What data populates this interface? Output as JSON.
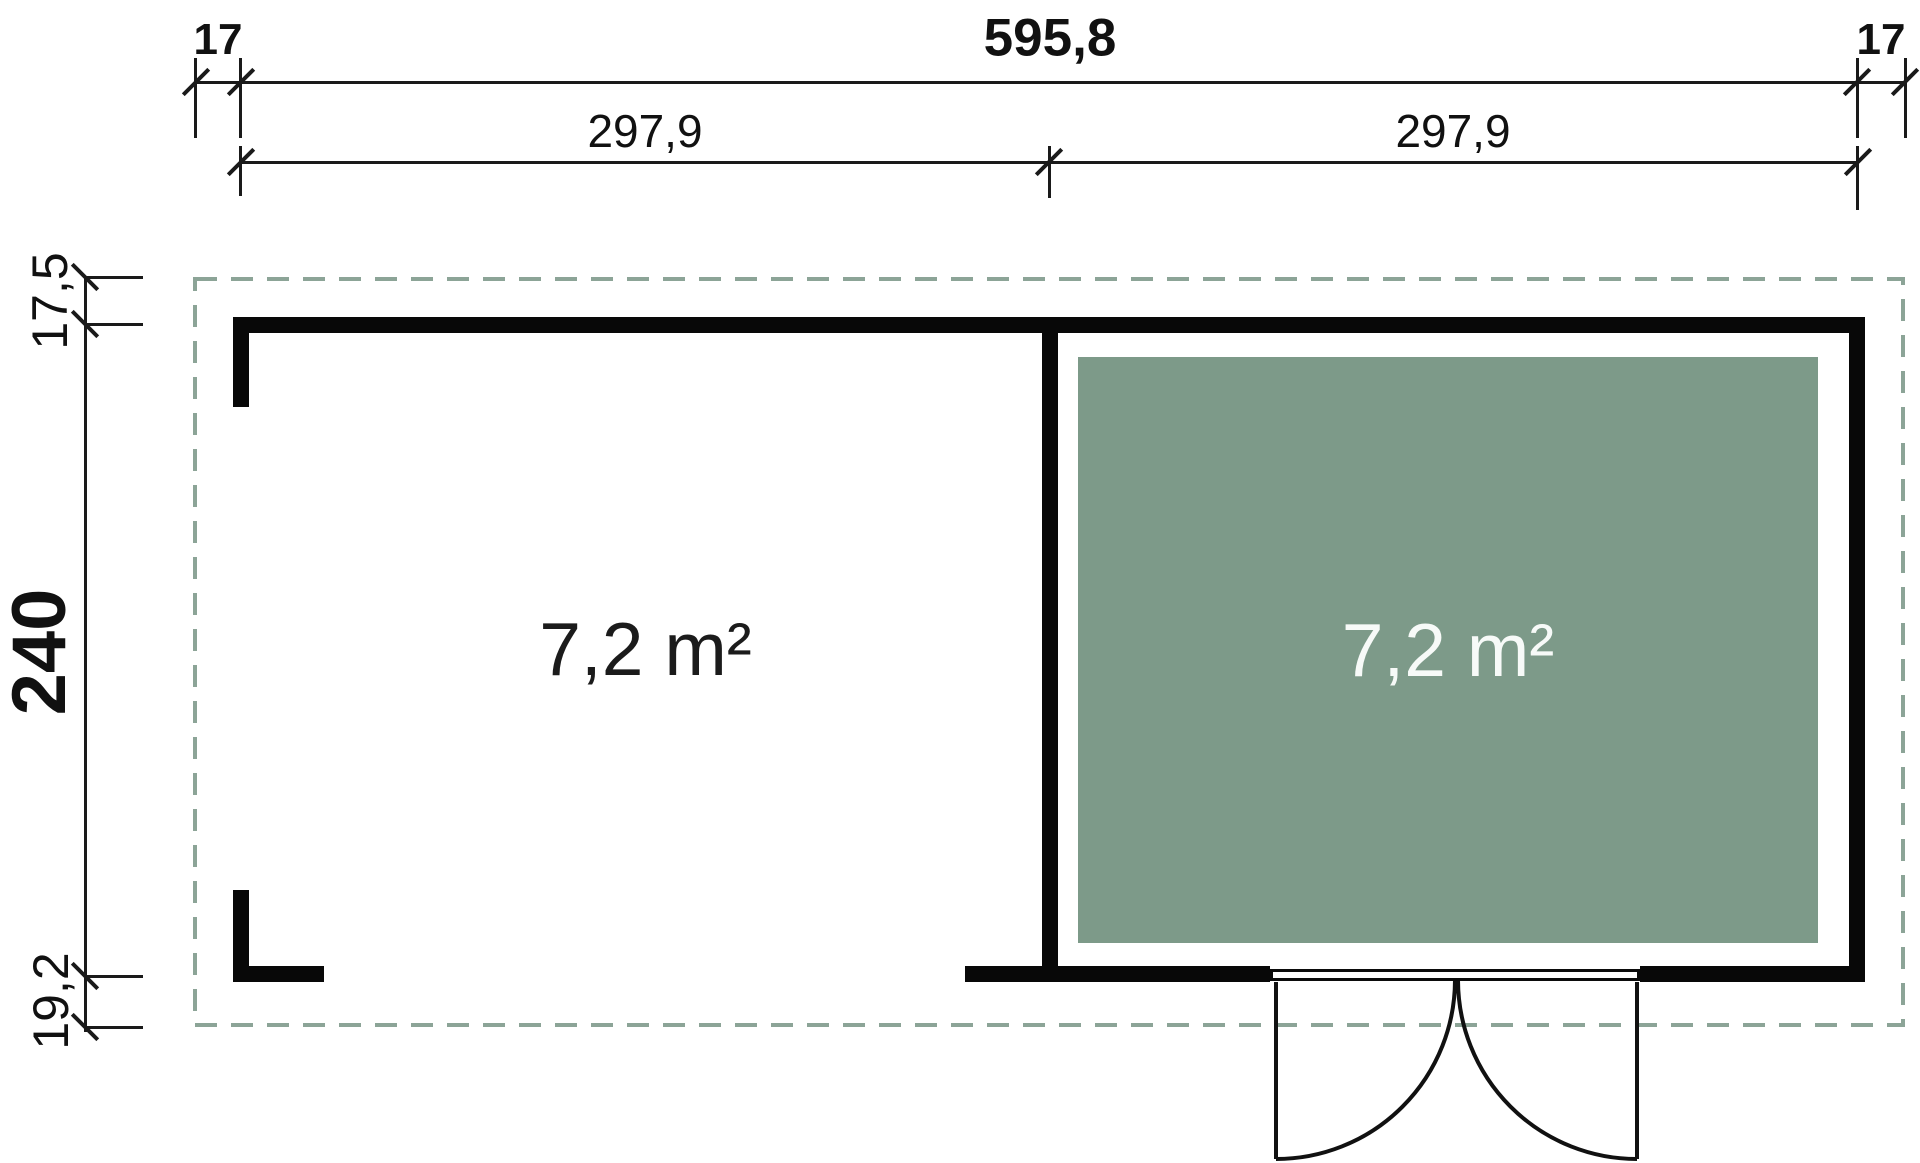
{
  "dimensions": {
    "total_width": "595,8",
    "overhang_left": "17",
    "overhang_right": "17",
    "section_left": "297,9",
    "section_right": "297,9",
    "overhang_top": "17,5",
    "depth": "240",
    "overhang_bottom": "19,2"
  },
  "rooms": {
    "left": {
      "area": "7,2 m²"
    },
    "right": {
      "area": "7,2 m²"
    }
  },
  "colors": {
    "wall": "#080808",
    "room_fill": "#7d9a89",
    "overhang_dash": "#8ca497",
    "room_label_light": "#f7faf8",
    "room_label_dark": "#1b1b1b"
  }
}
